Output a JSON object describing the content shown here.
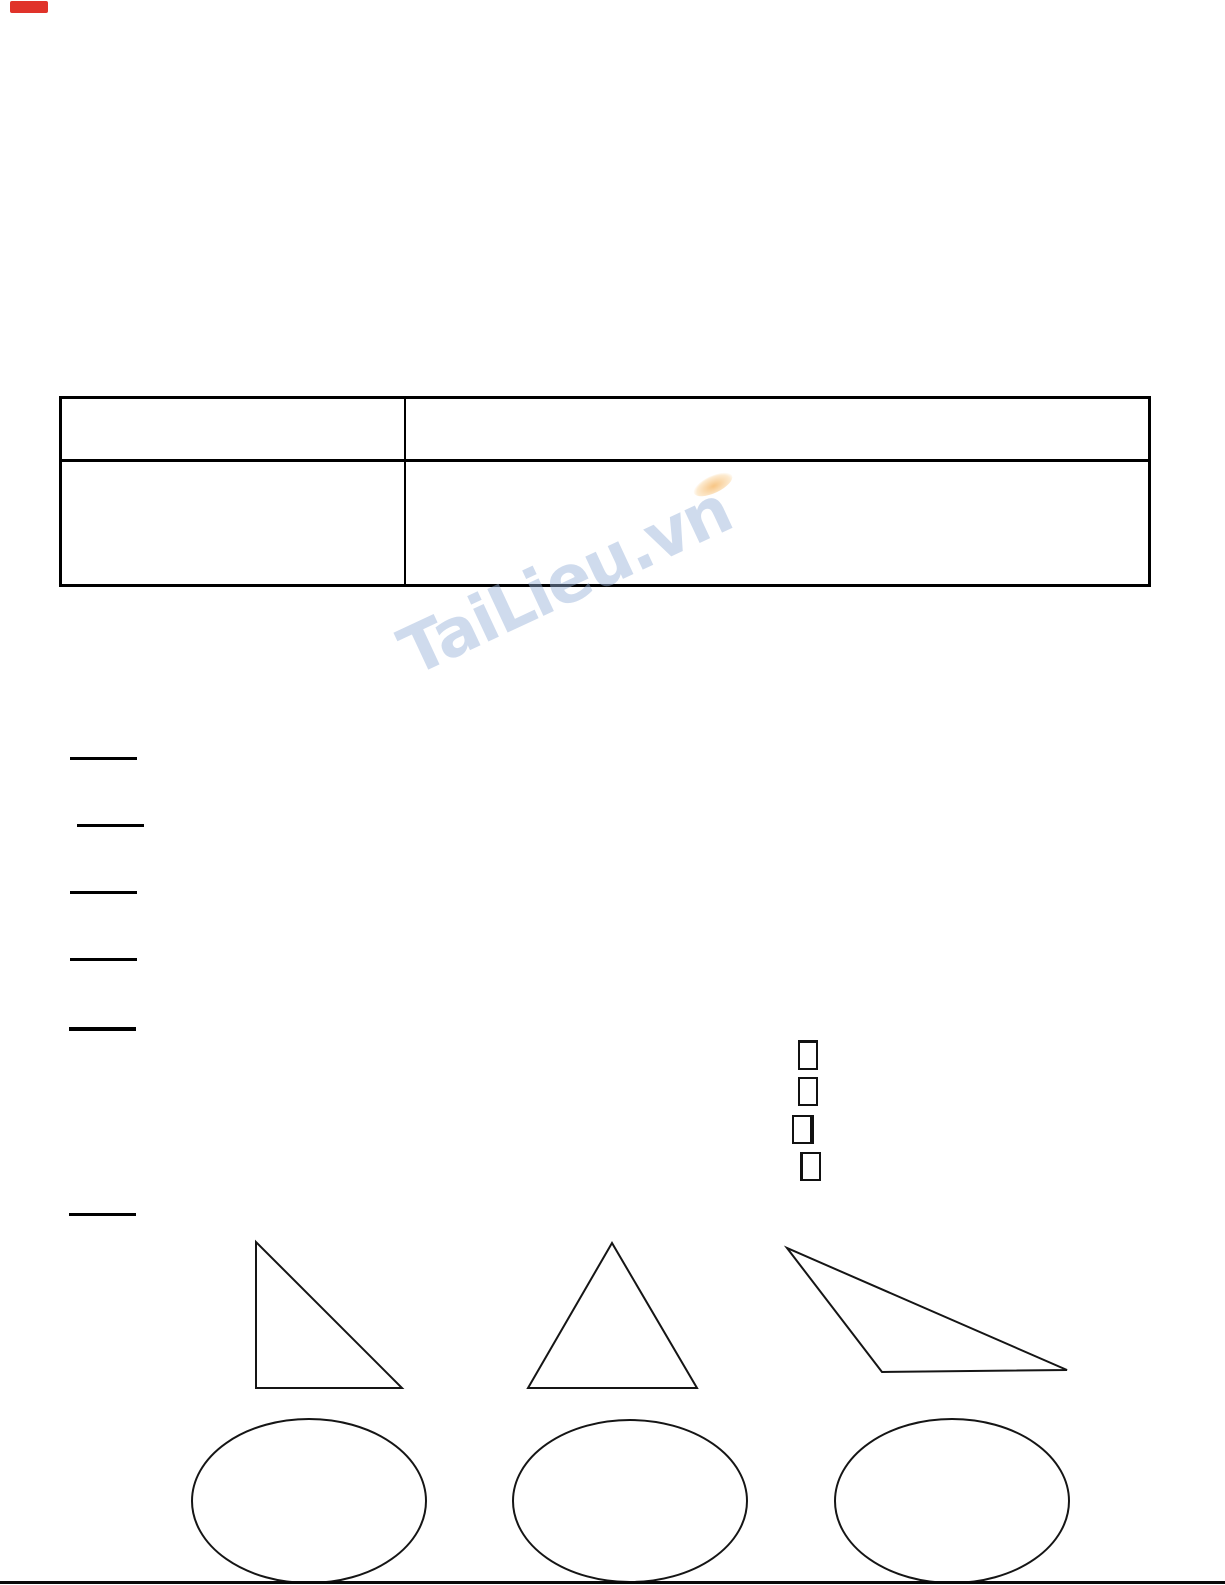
{
  "page": {
    "kind": "scanned worksheet page",
    "background_color": "#ffffff",
    "ink_color": "#000000"
  },
  "red_marker": {
    "color": "#e0332a"
  },
  "answer_table": {
    "rows": 2,
    "columns": 2,
    "cells": [
      [
        "",
        ""
      ],
      [
        "",
        ""
      ]
    ]
  },
  "watermark": {
    "text": "TaiLieu.vn",
    "color": "#94afd8",
    "accent_color": "#f3a642"
  },
  "answer_blanks": {
    "count": 6
  },
  "answer_boxes": {
    "count": 4
  },
  "figures": {
    "triangles": [
      "right-triangle",
      "isosceles-triangle",
      "obtuse-triangle"
    ],
    "ellipses": 3
  }
}
